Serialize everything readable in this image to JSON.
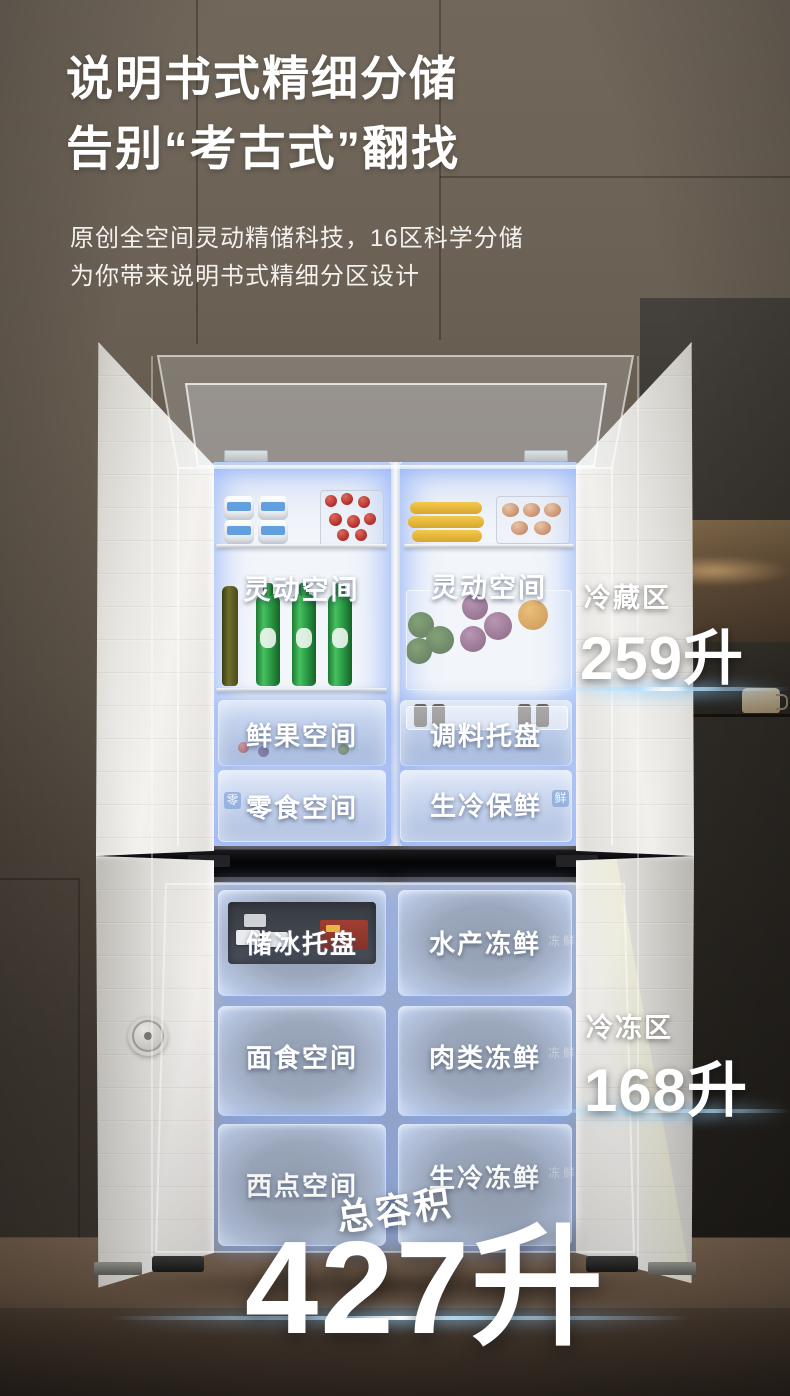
{
  "header": {
    "title_line1": "说明书式精细分储",
    "title_line2": "告别“考古式”翻找",
    "subtitle_line1": "原创全空间灵动精储科技，16区科学分储",
    "subtitle_line2": "为你带来说明书式精细分区设计"
  },
  "zones": {
    "refrigeration": {
      "name": "冷藏区",
      "capacity": "259升"
    },
    "freezing": {
      "name": "冷冻区",
      "capacity": "168升"
    },
    "total": {
      "name": "总容积",
      "capacity": "427升"
    }
  },
  "compartments": {
    "flex_left": "灵动空间",
    "flex_right": "灵动空间",
    "fresh_fruit": "鲜果空间",
    "seasoning": "调料托盘",
    "snack": "零食空间",
    "chilled_fresh": "生冷保鲜",
    "ice_tray": "储冰托盘",
    "seafood_frozen": "水产冻鲜",
    "pasta": "面食空间",
    "meat_frozen": "肉类冻鲜",
    "pastry": "西点空间",
    "raw_frozen": "生冷冻鲜"
  },
  "marks": {
    "snack_badge": "零",
    "fresh_badge": "鲜",
    "frozen_faint": "冻鲜"
  },
  "colors": {
    "glow_blue": "#96b4f8",
    "streak_blue": "#bfe3ff",
    "wall_taupe": "#6a6055",
    "floor_wood": "#6e5a48"
  }
}
